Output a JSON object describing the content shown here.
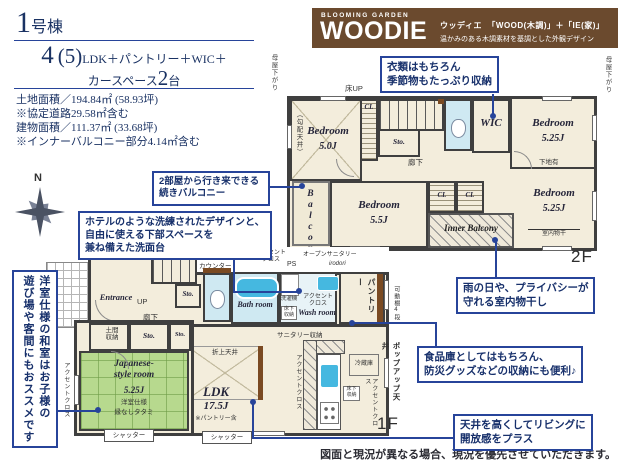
{
  "header": {
    "building_num": "1",
    "building_suffix": "号棟",
    "plan_num": "4",
    "plan_paren": "(5)",
    "plan_suffix": "LDK＋パントリー＋WIC＋",
    "car_prefix": "カースペース",
    "car_num": "2",
    "car_suffix": "台",
    "specs": [
      "土地面積／194.84㎡ (58.93坪)",
      "※協定道路29.58㎡含む",
      "建物面積／111.37㎡ (33.68坪)",
      "※インナーバルコニー部分4.14㎡含む"
    ]
  },
  "brand": {
    "eyebrow": "BLOOMING GARDEN",
    "logo": "WOODIE",
    "kana": "ウッディエ",
    "formula": "「WOOD(木調)」＋「IE(家)」",
    "tagline": "温かみのある木調素材を基調とした外観デザイン"
  },
  "compass": {
    "label": "N"
  },
  "callouts": {
    "wic": "衣類はもちろん\n季節物もたっぷり収納",
    "balcony": "2部屋から行き来できる\n続きバルコニー",
    "washstand": "ホテルのような洗練されたデザインと、\n自由に使える下部スペースを\n兼ね備えた洗面台",
    "drying": "雨の日や、プライバシーが\n守れる室内物干し",
    "pantry": "食品庫としてはもちろん、\n防災グッズなどの収納にも便利♪",
    "ceiling": "天井を高くしてリビングに\n開放感をプラス",
    "tatami": "洋室仕様の和室はお子様の\n遊び場や客間にもおススメです"
  },
  "plan2f": {
    "floor": "2F",
    "moya_left": "母屋下がり",
    "moya_right": "母屋下がり",
    "floor_up": "床UP",
    "counter": "カウンター",
    "bedroom_nw": {
      "name": "Bedroom",
      "size": "5.0J",
      "note": "（勾配天井）"
    },
    "cl_top": "CL",
    "sto": "Sto.",
    "dn": "DN",
    "hall": "廊下",
    "wic": "WIC",
    "bedroom_ne": {
      "name": "Bedroom",
      "size": "5.25J"
    },
    "shitaji": "下地有",
    "balcony": "Balcony",
    "bedroom_s": {
      "name": "Bedroom",
      "size": "5.5J"
    },
    "cl_a": "CL",
    "cl_b": "CL",
    "bedroom_se": {
      "name": "Bedroom",
      "size": "5.25J"
    },
    "monohoshi": "室内物干",
    "inner_balcony": "Inner Balcony"
  },
  "plan1f": {
    "floor": "1F",
    "counter": "カウンター",
    "accent_top": "アクセント\nクロス",
    "ps": "PS",
    "open_sanitary": "オープンサニタリー",
    "irodori": "irodori",
    "entrance": "Entrance",
    "up": "UP",
    "hall": "廊下",
    "sto_hall": "Sto.",
    "washer": "洗濯機",
    "bath": "Bath room",
    "wash": "Wash room",
    "accent_wash": "アクセント\nクロス",
    "yukashita_wash": "床下\n収納",
    "sanitary_sto": "サニタリー収納",
    "pantry": "パントリー",
    "kadana_pantry": "可動棚4段",
    "doma": "土間\n収納",
    "sto_a": "Sto.",
    "sto_b": "Sto.",
    "kadana_west": "可動棚4段",
    "accent_west": "アクセントクロス",
    "japanese": {
      "name": "Japanese-\nstyle room",
      "size": "5.25J",
      "note1": "洋室仕様",
      "note2": "縁なしタタミ"
    },
    "oriage": "折上天井",
    "ldk": {
      "name": "LDK",
      "size": "17.5J",
      "note": "※パントリー含"
    },
    "accent_mid": "アクセントクロス",
    "fridge": "冷蔵庫",
    "yukashita_kitchen": "床下\n収納",
    "accent_kitchen": "アクセントクロス",
    "popup": "ポップアップ天井",
    "shutter_a": "シャッター",
    "shutter_b": "シャッター"
  },
  "footer": {
    "disclaimer": "図面と現況が異なる場合、現況を優先させていただきます。"
  },
  "colors": {
    "accent_blue": "#27449a",
    "navy_text": "#1a3263",
    "brand_brown": "#6b4a2e",
    "room_cream": "#f3eddc",
    "tatami_green": "#b7d98e",
    "water_blue": "#cfe9f2",
    "fixture_blue": "#45b8e0",
    "wall_dark": "#3f3f3f"
  }
}
